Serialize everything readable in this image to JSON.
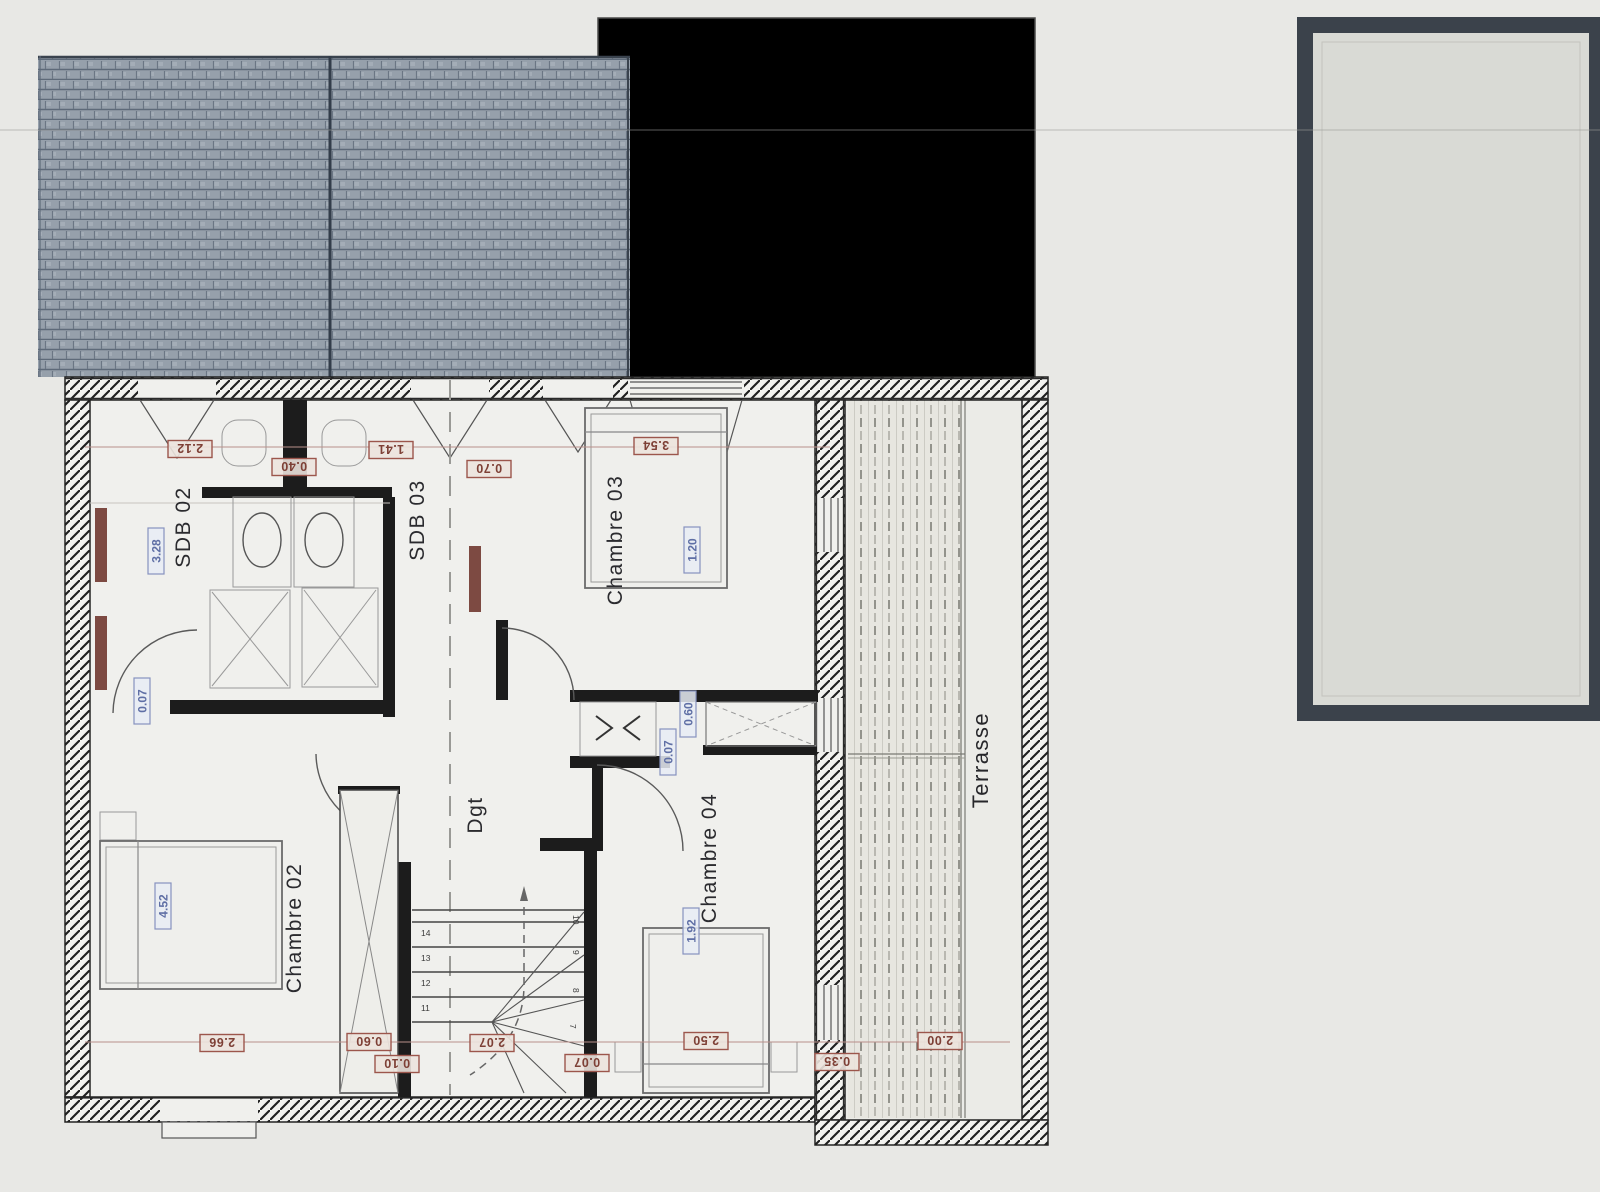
{
  "document": {
    "kind": "scanned architectural floor plan, upper storey"
  },
  "colors": {
    "paper": "#e8e8e5",
    "plan_interior": "#f0f0ed",
    "wall_ink": "#1c1c1c",
    "dimension_red": "#7e4036",
    "dimension_blue": "#5f6fa5",
    "roof_tile": "#96a0ab",
    "pool_frame": "#3b424b",
    "pool_interior": "#d9dad5",
    "deck": "#e7e6e0"
  },
  "rooms": [
    {
      "label": "SDB 02"
    },
    {
      "label": "SDB 03"
    },
    {
      "label": "Chambre 03"
    },
    {
      "label": "Chambre 02"
    },
    {
      "label": "Dgt"
    },
    {
      "label": "Chambre 04"
    },
    {
      "label": "Terrasse"
    }
  ],
  "dims_red": [
    {
      "value": "2.12"
    },
    {
      "value": "0.40"
    },
    {
      "value": "1.41"
    },
    {
      "value": "0.70"
    },
    {
      "value": "3.54"
    },
    {
      "value": "2.66"
    },
    {
      "value": "0.60"
    },
    {
      "value": "0.10"
    },
    {
      "value": "2.07"
    },
    {
      "value": "0.07"
    },
    {
      "value": "2.50"
    },
    {
      "value": "0.35"
    },
    {
      "value": "2.00"
    }
  ],
  "dims_blue": [
    {
      "value": "3.28"
    },
    {
      "value": "0.07"
    },
    {
      "value": "4.52"
    },
    {
      "value": "1.20"
    },
    {
      "value": "0.60"
    },
    {
      "value": "0.07"
    },
    {
      "value": "1.92"
    }
  ],
  "stairs": {
    "left_numbers": [
      "14",
      "13",
      "12",
      "11"
    ],
    "right_numbers": [
      "10",
      "9",
      "8",
      "7"
    ]
  }
}
